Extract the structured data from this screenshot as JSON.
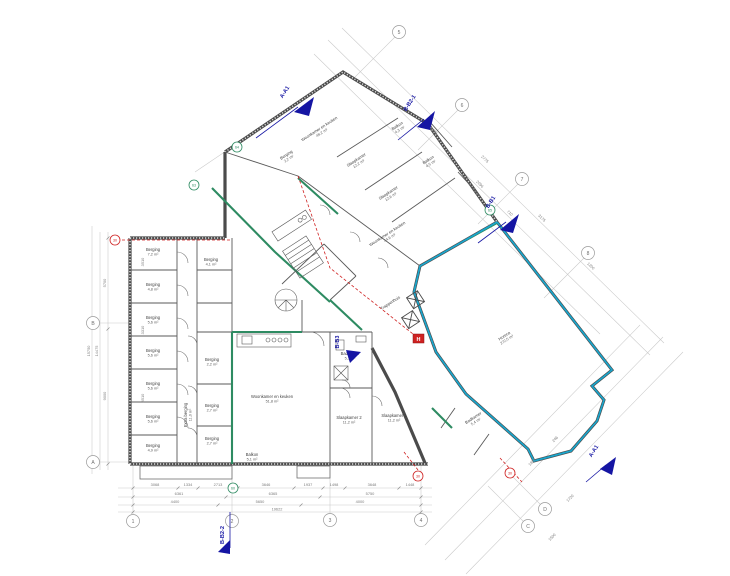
{
  "drawing": {
    "type": "architectural-floor-plan",
    "language": "Dutch",
    "background": "#ffffff"
  },
  "colors": {
    "wall": "#4b4b4b",
    "facade_highlight_cyan": "#19a6cd",
    "interior_highlight_green": "#2e8b62",
    "fire_safety_red": "#cf2121",
    "section_marker_navy": "#1515a3",
    "dimension_gray": "#9a9a9a"
  },
  "rooms": [
    {
      "name": "Berging",
      "area": "7,2 m²"
    },
    {
      "name": "Berging",
      "area": "4,8 m²"
    },
    {
      "name": "Berging",
      "area": "5,6 m²"
    },
    {
      "name": "Berging",
      "area": "5,6 m²"
    },
    {
      "name": "Berging",
      "area": "5,6 m²"
    },
    {
      "name": "Berging",
      "area": "5,6 m²"
    },
    {
      "name": "Berging",
      "area": "4,9 m²"
    },
    {
      "name": "Berging",
      "area": "4,1 m²"
    },
    {
      "name": "Berging",
      "area": "2,2 m²"
    },
    {
      "name": "Berging",
      "area": "2,7 m²"
    },
    {
      "name": "Berging",
      "area": "2,7 m²"
    },
    {
      "name": "Extra berging",
      "area": "11,0 m²"
    },
    {
      "name": "Woonkamer en keuken",
      "area": "51,8 m²"
    },
    {
      "name": "Slaapkamer 2",
      "area": "11,2 m²"
    },
    {
      "name": "Slaapkamer 1",
      "area": "11,2 m²"
    },
    {
      "name": "Badkamer",
      "area": "5,1 m²"
    },
    {
      "name": "Balkon",
      "area": "5,1 m²"
    },
    {
      "name": "Woonkamer en keuken",
      "area": "48,2 m²"
    },
    {
      "name": "Berging",
      "area": "2,2 m²"
    },
    {
      "name": "Slaapkamer",
      "area": "12,2 m²"
    },
    {
      "name": "Slaapkamer",
      "area": "12,6 m²"
    },
    {
      "name": "Balkon",
      "area": "4,3 m²"
    },
    {
      "name": "Balkon",
      "area": "4,5 m²"
    },
    {
      "name": "Woonkamer en keuken",
      "area": "44,6 m²"
    },
    {
      "name": "Trappenhuis",
      "area": ""
    },
    {
      "name": "Horeca",
      "area": "272,5 m²"
    },
    {
      "name": "Badkamer",
      "area": "5,4 m²"
    }
  ],
  "section_markers": [
    {
      "label": "A-A1"
    },
    {
      "label": "B-B2-1"
    },
    {
      "label": "B-B1"
    },
    {
      "label": "B-B3"
    },
    {
      "label": "B-B2-2"
    },
    {
      "label": "A-A1"
    }
  ],
  "grid_bubbles": [
    {
      "label": "1"
    },
    {
      "label": "2"
    },
    {
      "label": "3"
    },
    {
      "label": "4"
    },
    {
      "label": "A"
    },
    {
      "label": "B"
    },
    {
      "label": "C"
    },
    {
      "label": "D"
    },
    {
      "label": "5"
    },
    {
      "label": "6"
    },
    {
      "label": "7"
    },
    {
      "label": "8"
    }
  ],
  "detail_bubbles": [
    {
      "label": "64"
    },
    {
      "label": "63"
    },
    {
      "label": "65"
    },
    {
      "label": "60"
    }
  ],
  "fire_bubbles": [
    {
      "label": "30"
    },
    {
      "label": "30"
    },
    {
      "label": "30"
    }
  ],
  "symbols": {
    "fire_hose_reel": "H"
  },
  "dims": {
    "bottom1": [
      "3068",
      "1334",
      "2713",
      "3646",
      "1937",
      "1498",
      "3648",
      "1448"
    ],
    "bottom2": [
      "6361",
      "6365",
      "5750"
    ],
    "bottom3": [
      "4400",
      "5650",
      "4000"
    ],
    "total": "19622",
    "left": [
      "5700",
      "9000",
      "14475",
      "15750"
    ],
    "left_wall": [
      "3510",
      "3310",
      "3510"
    ],
    "diag": [
      "5096",
      "2775",
      "2096",
      "710",
      "3175",
      "1200"
    ],
    "diag_br": [
      "1829",
      "246",
      "1720",
      "1500"
    ]
  }
}
